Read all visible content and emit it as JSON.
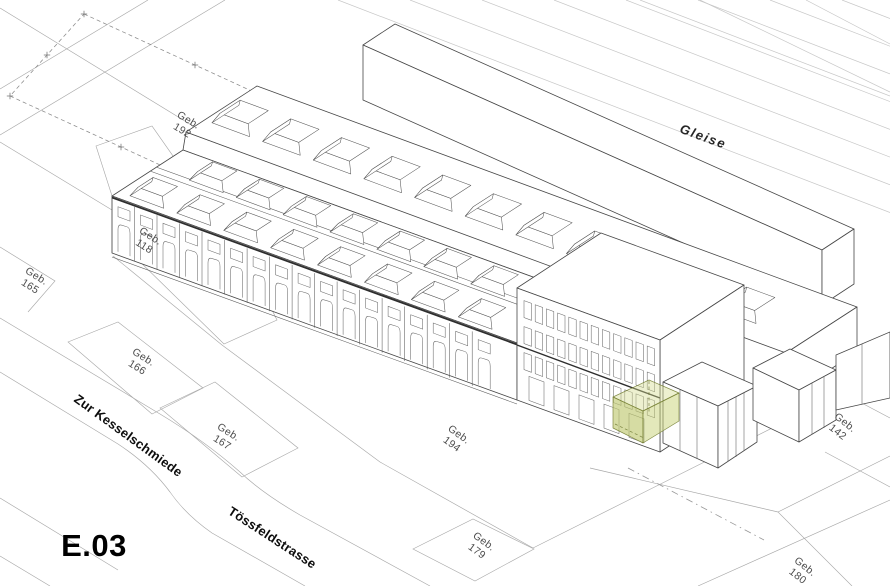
{
  "drawing": {
    "code": "E.03"
  },
  "palette": {
    "highlight_green": "#ccd68d",
    "building_line": "#474747",
    "ground_line": "#a8a8a8",
    "rail_line": "#c7c7c7"
  },
  "labels": [
    {
      "id": "geb-192",
      "text": "Geb.\n192"
    },
    {
      "id": "geb-118",
      "text": "Geb.\n118"
    },
    {
      "id": "geb-165",
      "text": "Geb.\n165"
    },
    {
      "id": "geb-166",
      "text": "Geb.\n166"
    },
    {
      "id": "geb-167",
      "text": "Geb.\n167"
    },
    {
      "id": "geb-194",
      "text": "Geb.\n194"
    },
    {
      "id": "geb-179",
      "text": "Geb.\n179"
    },
    {
      "id": "geb-142",
      "text": "Geb.\n142"
    },
    {
      "id": "geb-180",
      "text": "Geb.\n180"
    },
    {
      "id": "gleise",
      "text": "Gleise"
    },
    {
      "id": "street-zur-kesselschmiede",
      "text": "Zur Kesselschmiede"
    },
    {
      "id": "street-toessfeldstrasse",
      "text": "Tössfeldstrasse"
    }
  ]
}
